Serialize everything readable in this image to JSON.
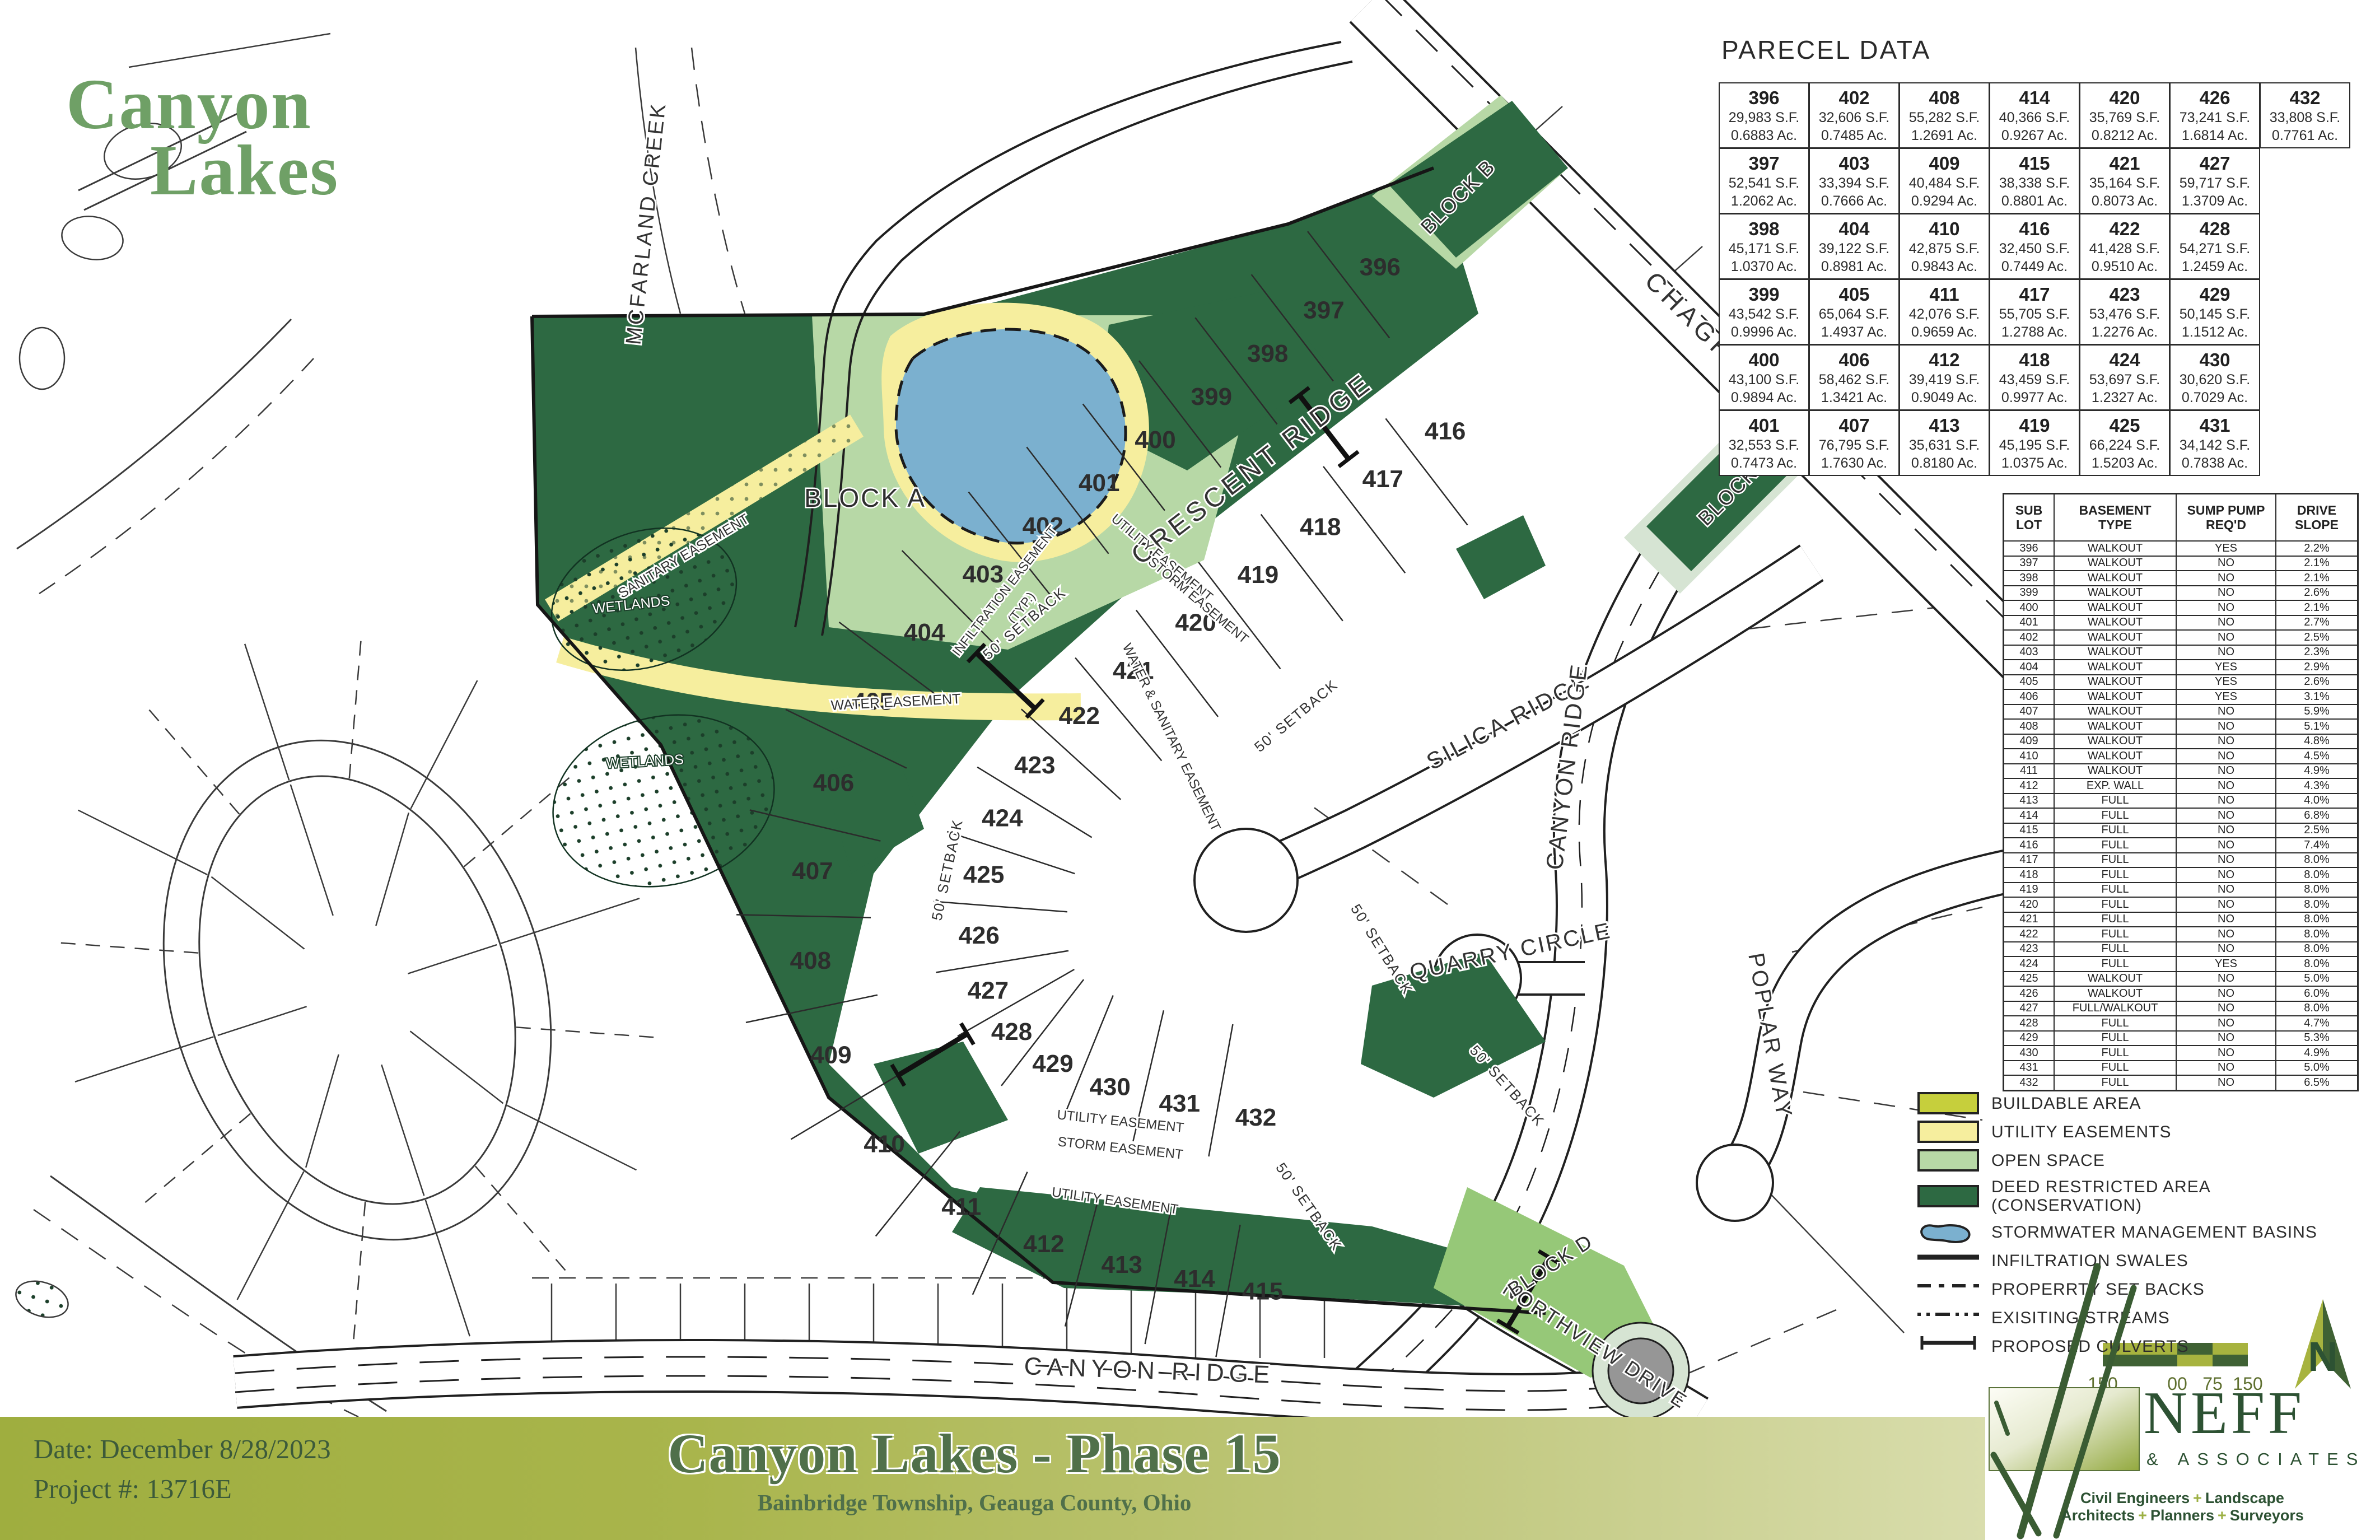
{
  "brand": {
    "line1": "Canyon",
    "line2": "Lakes"
  },
  "parcel_data": {
    "title": "PARECEL DATA",
    "rows": [
      [
        {
          "no": "396",
          "sf": "29,983 S.F.",
          "ac": "0.6883 Ac."
        },
        {
          "no": "402",
          "sf": "32,606 S.F.",
          "ac": "0.7485 Ac."
        },
        {
          "no": "408",
          "sf": "55,282 S.F.",
          "ac": "1.2691 Ac."
        },
        {
          "no": "414",
          "sf": "40,366 S.F.",
          "ac": "0.9267 Ac."
        },
        {
          "no": "420",
          "sf": "35,769 S.F.",
          "ac": "0.8212 Ac."
        },
        {
          "no": "426",
          "sf": "73,241 S.F.",
          "ac": "1.6814 Ac."
        },
        {
          "no": "432",
          "sf": "33,808 S.F.",
          "ac": "0.7761 Ac."
        }
      ],
      [
        {
          "no": "397",
          "sf": "52,541 S.F.",
          "ac": "1.2062 Ac."
        },
        {
          "no": "403",
          "sf": "33,394 S.F.",
          "ac": "0.7666 Ac."
        },
        {
          "no": "409",
          "sf": "40,484 S.F.",
          "ac": "0.9294 Ac."
        },
        {
          "no": "415",
          "sf": "38,338 S.F.",
          "ac": "0.8801 Ac."
        },
        {
          "no": "421",
          "sf": "35,164 S.F.",
          "ac": "0.8073 Ac."
        },
        {
          "no": "427",
          "sf": "59,717 S.F.",
          "ac": "1.3709 Ac."
        }
      ],
      [
        {
          "no": "398",
          "sf": "45,171 S.F.",
          "ac": "1.0370 Ac."
        },
        {
          "no": "404",
          "sf": "39,122 S.F.",
          "ac": "0.8981 Ac."
        },
        {
          "no": "410",
          "sf": "42,875 S.F.",
          "ac": "0.9843 Ac."
        },
        {
          "no": "416",
          "sf": "32,450 S.F.",
          "ac": "0.7449 Ac."
        },
        {
          "no": "422",
          "sf": "41,428 S.F.",
          "ac": "0.9510 Ac."
        },
        {
          "no": "428",
          "sf": "54,271 S.F.",
          "ac": "1.2459 Ac."
        }
      ],
      [
        {
          "no": "399",
          "sf": "43,542 S.F.",
          "ac": "0.9996 Ac."
        },
        {
          "no": "405",
          "sf": "65,064 S.F.",
          "ac": "1.4937 Ac."
        },
        {
          "no": "411",
          "sf": "42,076 S.F.",
          "ac": "0.9659 Ac."
        },
        {
          "no": "417",
          "sf": "55,705 S.F.",
          "ac": "1.2788 Ac."
        },
        {
          "no": "423",
          "sf": "53,476 S.F.",
          "ac": "1.2276 Ac."
        },
        {
          "no": "429",
          "sf": "50,145 S.F.",
          "ac": "1.1512 Ac."
        }
      ],
      [
        {
          "no": "400",
          "sf": "43,100 S.F.",
          "ac": "0.9894 Ac."
        },
        {
          "no": "406",
          "sf": "58,462 S.F.",
          "ac": "1.3421 Ac."
        },
        {
          "no": "412",
          "sf": "39,419 S.F.",
          "ac": "0.9049 Ac."
        },
        {
          "no": "418",
          "sf": "43,459 S.F.",
          "ac": "0.9977 Ac."
        },
        {
          "no": "424",
          "sf": "53,697 S.F.",
          "ac": "1.2327 Ac."
        },
        {
          "no": "430",
          "sf": "30,620 S.F.",
          "ac": "0.7029 Ac."
        }
      ],
      [
        {
          "no": "401",
          "sf": "32,553 S.F.",
          "ac": "0.7473 Ac."
        },
        {
          "no": "407",
          "sf": "76,795 S.F.",
          "ac": "1.7630 Ac."
        },
        {
          "no": "413",
          "sf": "35,631 S.F.",
          "ac": "0.8180 Ac."
        },
        {
          "no": "419",
          "sf": "45,195 S.F.",
          "ac": "1.0375 Ac."
        },
        {
          "no": "425",
          "sf": "66,224 S.F.",
          "ac": "1.5203 Ac."
        },
        {
          "no": "431",
          "sf": "34,142 S.F.",
          "ac": "0.7838 Ac."
        }
      ]
    ]
  },
  "sublot_table": {
    "headers": [
      [
        "SUB",
        "LOT"
      ],
      [
        "BASEMENT",
        "TYPE"
      ],
      [
        "SUMP PUMP",
        "REQ'D"
      ],
      [
        "DRIVE",
        "SLOPE"
      ]
    ],
    "rows": [
      [
        "396",
        "WALKOUT",
        "YES",
        "2.2%"
      ],
      [
        "397",
        "WALKOUT",
        "NO",
        "2.1%"
      ],
      [
        "398",
        "WALKOUT",
        "NO",
        "2.1%"
      ],
      [
        "399",
        "WALKOUT",
        "NO",
        "2.6%"
      ],
      [
        "400",
        "WALKOUT",
        "NO",
        "2.1%"
      ],
      [
        "401",
        "WALKOUT",
        "NO",
        "2.7%"
      ],
      [
        "402",
        "WALKOUT",
        "NO",
        "2.5%"
      ],
      [
        "403",
        "WALKOUT",
        "NO",
        "2.3%"
      ],
      [
        "404",
        "WALKOUT",
        "YES",
        "2.9%"
      ],
      [
        "405",
        "WALKOUT",
        "YES",
        "2.6%"
      ],
      [
        "406",
        "WALKOUT",
        "YES",
        "3.1%"
      ],
      [
        "407",
        "WALKOUT",
        "NO",
        "5.9%"
      ],
      [
        "408",
        "WALKOUT",
        "NO",
        "5.1%"
      ],
      [
        "409",
        "WALKOUT",
        "NO",
        "4.8%"
      ],
      [
        "410",
        "WALKOUT",
        "NO",
        "4.5%"
      ],
      [
        "411",
        "WALKOUT",
        "NO",
        "4.9%"
      ],
      [
        "412",
        "EXP. WALL",
        "NO",
        "4.3%"
      ],
      [
        "413",
        "FULL",
        "NO",
        "4.0%"
      ],
      [
        "414",
        "FULL",
        "NO",
        "6.8%"
      ],
      [
        "415",
        "FULL",
        "NO",
        "2.5%"
      ],
      [
        "416",
        "FULL",
        "NO",
        "7.4%"
      ],
      [
        "417",
        "FULL",
        "NO",
        "8.0%"
      ],
      [
        "418",
        "FULL",
        "NO",
        "8.0%"
      ],
      [
        "419",
        "FULL",
        "NO",
        "8.0%"
      ],
      [
        "420",
        "FULL",
        "NO",
        "8.0%"
      ],
      [
        "421",
        "FULL",
        "NO",
        "8.0%"
      ],
      [
        "422",
        "FULL",
        "NO",
        "8.0%"
      ],
      [
        "423",
        "FULL",
        "NO",
        "8.0%"
      ],
      [
        "424",
        "FULL",
        "YES",
        "8.0%"
      ],
      [
        "425",
        "WALKOUT",
        "NO",
        "5.0%"
      ],
      [
        "426",
        "WALKOUT",
        "NO",
        "6.0%"
      ],
      [
        "427",
        "FULL/WALKOUT",
        "NO",
        "8.0%"
      ],
      [
        "428",
        "FULL",
        "NO",
        "4.7%"
      ],
      [
        "429",
        "FULL",
        "NO",
        "5.3%"
      ],
      [
        "430",
        "FULL",
        "NO",
        "4.9%"
      ],
      [
        "431",
        "FULL",
        "NO",
        "5.0%"
      ],
      [
        "432",
        "FULL",
        "NO",
        "6.5%"
      ]
    ]
  },
  "legend": {
    "items": [
      {
        "kind": "fill",
        "color": "#c6cf3c",
        "label": "BUILDABLE AREA"
      },
      {
        "kind": "fill",
        "color": "#f6ee9e",
        "label": "UTILITY EASEMENTS"
      },
      {
        "kind": "fill",
        "color": "#b7d8a6",
        "label": "OPEN SPACE"
      },
      {
        "kind": "fill",
        "color": "#2d6942",
        "label": "DEED RESTRICTED AREA",
        "label2": "(CONSERVATION)"
      },
      {
        "kind": "basin",
        "color": "#7bb0cf",
        "label": "STORMWATER MANAGEMENT BASINS"
      },
      {
        "kind": "line-solid",
        "label": "INFILTRATION SWALES"
      },
      {
        "kind": "line-dashed",
        "label": "PROPERRTY SET BACKS"
      },
      {
        "kind": "line-dashdot",
        "label": "EXISITING STREAMS"
      },
      {
        "kind": "line-culvert",
        "label": "PROPOSED CULVERTS"
      }
    ]
  },
  "scale_bar": {
    "labels": [
      "150",
      "00",
      "75",
      "150"
    ]
  },
  "north_arrow": {
    "letter": "N"
  },
  "map": {
    "lots": {
      "outer": [
        "396",
        "397",
        "398",
        "399",
        "400",
        "401",
        "402",
        "403",
        "404",
        "405",
        "406",
        "407",
        "408",
        "409",
        "410",
        "411",
        "412",
        "413",
        "414",
        "415"
      ],
      "inner": [
        "416",
        "417",
        "418",
        "419",
        "420",
        "421",
        "422",
        "423",
        "424",
        "425",
        "426",
        "427",
        "428",
        "429",
        "430",
        "431",
        "432"
      ]
    },
    "labels": {
      "crescent_ridge": "CRESCENT RIDGE",
      "chagrin": "CHAGRIN ROAD",
      "silica": "SILICA RIDGE",
      "canyon_ridge": "CANYON RIDGE",
      "quarry": "QUARRY CIRCLE",
      "poplar": "POPLAR WAY",
      "northview": "NORTHVIEW DRIVE",
      "mcfarland": "MCFARLAND CREEK",
      "block_a": "BLOCK A",
      "block_b": "BLOCK B",
      "block_c": "BLOCK C",
      "block_d": "BLOCK D",
      "wetlands": "WETLANDS",
      "water_easement": "WATER EASEMENT",
      "sanitary_easement": "SANITARY EASEMENT",
      "water_sanitary": "WATER & SANITARY EASEMENT",
      "utility_easement": "UTILITY EASEMENT",
      "storm_easement": "STORM EASEMENT",
      "infiltration1": "INFILTRATION EASEMENT",
      "infiltration2": "(TYP.)",
      "setback": "50' SETBACK"
    }
  },
  "title_block": {
    "date_label": "Date: December 8/28/2023",
    "project_label": "Project #: 13716E",
    "title": "Canyon Lakes - Phase 15",
    "subtitle": "Bainbridge Township, Geauga County, Ohio"
  },
  "neff": {
    "name": "NEFF",
    "sub": "& ASSOCIATES",
    "tagline_parts": [
      "Civil Engineers",
      "Landscape Architects",
      "Planners",
      "Surveyors"
    ],
    "plus": "+"
  },
  "colors": {
    "buildable": "#c6cf3c",
    "utility_easement": "#f6ee9e",
    "open_space": "#b7d8a6",
    "setback_band": "#d6e4d3",
    "deed_restricted": "#2d6942",
    "block_d_green": "#96c878",
    "basin_blue": "#7bb0cf",
    "road_gray": "#969696",
    "bar_olive": "#a0ac3e",
    "logo_green": "#6fa066",
    "neff_green": "#2d5233"
  }
}
